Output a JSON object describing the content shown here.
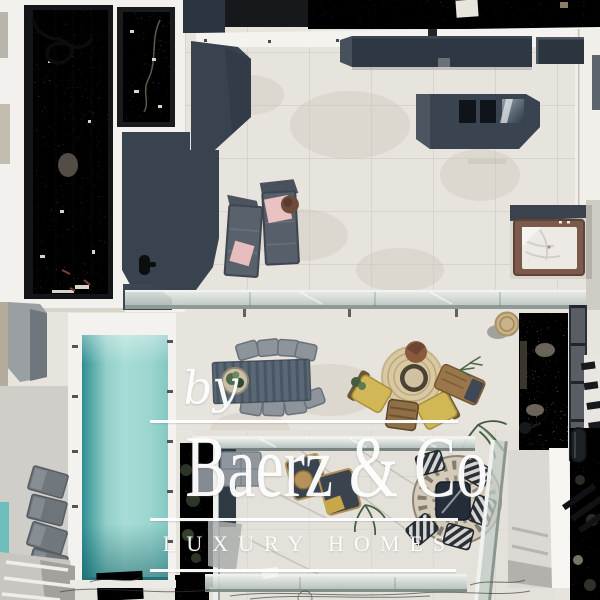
{
  "watermark": {
    "prefix": "by",
    "brand": "Baerz & Co",
    "tagline": "LUXURY HOMES",
    "color": "#ffffff"
  },
  "palette": {
    "terrace_cream": "#e7e3dd",
    "deck_white": "#f3f1ed",
    "shadow_navy": "#39434f",
    "roof_dark_taupe": "#6d655a",
    "pool_aqua_light": "#a8dcd6",
    "pool_teal_dark": "#2f8c93",
    "jacuzzi_wood_brown": "#7b5a4c",
    "cushion_pink": "#e7bdbd",
    "cushion_yellow": "#d2b757",
    "wicker_brown": "#99774a",
    "rug_straw": "#d9c8a0",
    "glass_grey": "#c9d1cc",
    "stone_beige": "#d1cabd",
    "gravel_brown": "#5d5244"
  }
}
